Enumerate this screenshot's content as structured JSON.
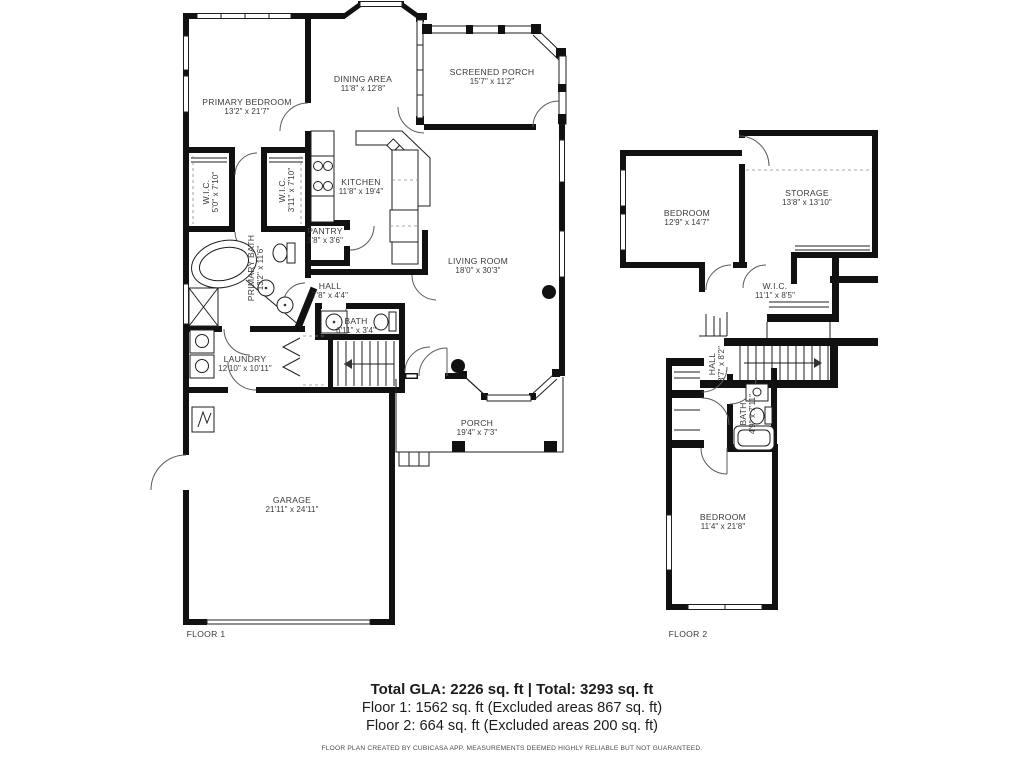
{
  "colors": {
    "wall": "#111111",
    "label_text": "#3a3a3a"
  },
  "floor1": {
    "label": "FLOOR 1",
    "rooms": {
      "primary_bedroom": {
        "name": "PRIMARY BEDROOM",
        "dims": "13'2\" x 21'7\""
      },
      "dining_area": {
        "name": "DINING AREA",
        "dims": "11'8\" x 12'8\""
      },
      "screened_porch": {
        "name": "SCREENED PORCH",
        "dims": "15'7\" x 11'2\""
      },
      "kitchen": {
        "name": "KITCHEN",
        "dims": "11'8\" x 19'4\""
      },
      "wic_left": {
        "name": "W.I.C.",
        "dims": "5'0\" x 7'10\""
      },
      "wic_right": {
        "name": "W.I.C.",
        "dims": "3'11\" x 7'10\""
      },
      "primary_bath": {
        "name": "PRIMARY BATH",
        "dims": "13'2\" x 11'6\""
      },
      "pantry": {
        "name": "PANTRY",
        "dims": "3'8\" x 3'6\""
      },
      "living_room": {
        "name": "LIVING ROOM",
        "dims": "18'0\" x 30'3\""
      },
      "hall": {
        "name": "HALL",
        "dims": "7'8\" x 4'4\""
      },
      "bath": {
        "name": "BATH",
        "dims": "6'11\" x 3'4\""
      },
      "laundry": {
        "name": "LAUNDRY",
        "dims": "12'10\" x 10'11\""
      },
      "porch": {
        "name": "PORCH",
        "dims": "19'4\" x 7'3\""
      },
      "garage": {
        "name": "GARAGE",
        "dims": "21'11\" x 24'11\""
      }
    }
  },
  "floor2": {
    "label": "FLOOR 2",
    "rooms": {
      "bedroom_top": {
        "name": "BEDROOM",
        "dims": "12'9\" x 14'7\""
      },
      "storage": {
        "name": "STORAGE",
        "dims": "13'8\" x 13'10\""
      },
      "wic": {
        "name": "W.I.C.",
        "dims": "11'1\" x 8'5\""
      },
      "hall": {
        "name": "HALL",
        "dims": "3'7\" x 8'2\""
      },
      "bath": {
        "name": "BATH",
        "dims": "4'9\" x 7'11\""
      },
      "bedroom_bottom": {
        "name": "BEDROOM",
        "dims": "11'4\" x 21'8\""
      }
    }
  },
  "summary": {
    "total_line": "Total GLA: 2226 sq. ft | Total: 3293 sq. ft",
    "floor1_line": "Floor 1: 1562 sq. ft (Excluded areas 867 sq. ft)",
    "floor2_line": "Floor 2: 664 sq. ft (Excluded areas 200 sq. ft)"
  },
  "disclaimer": "FLOOR PLAN CREATED BY CUBICASA APP. MEASUREMENTS DEEMED HIGHLY RELIABLE BUT NOT GUARANTEED."
}
